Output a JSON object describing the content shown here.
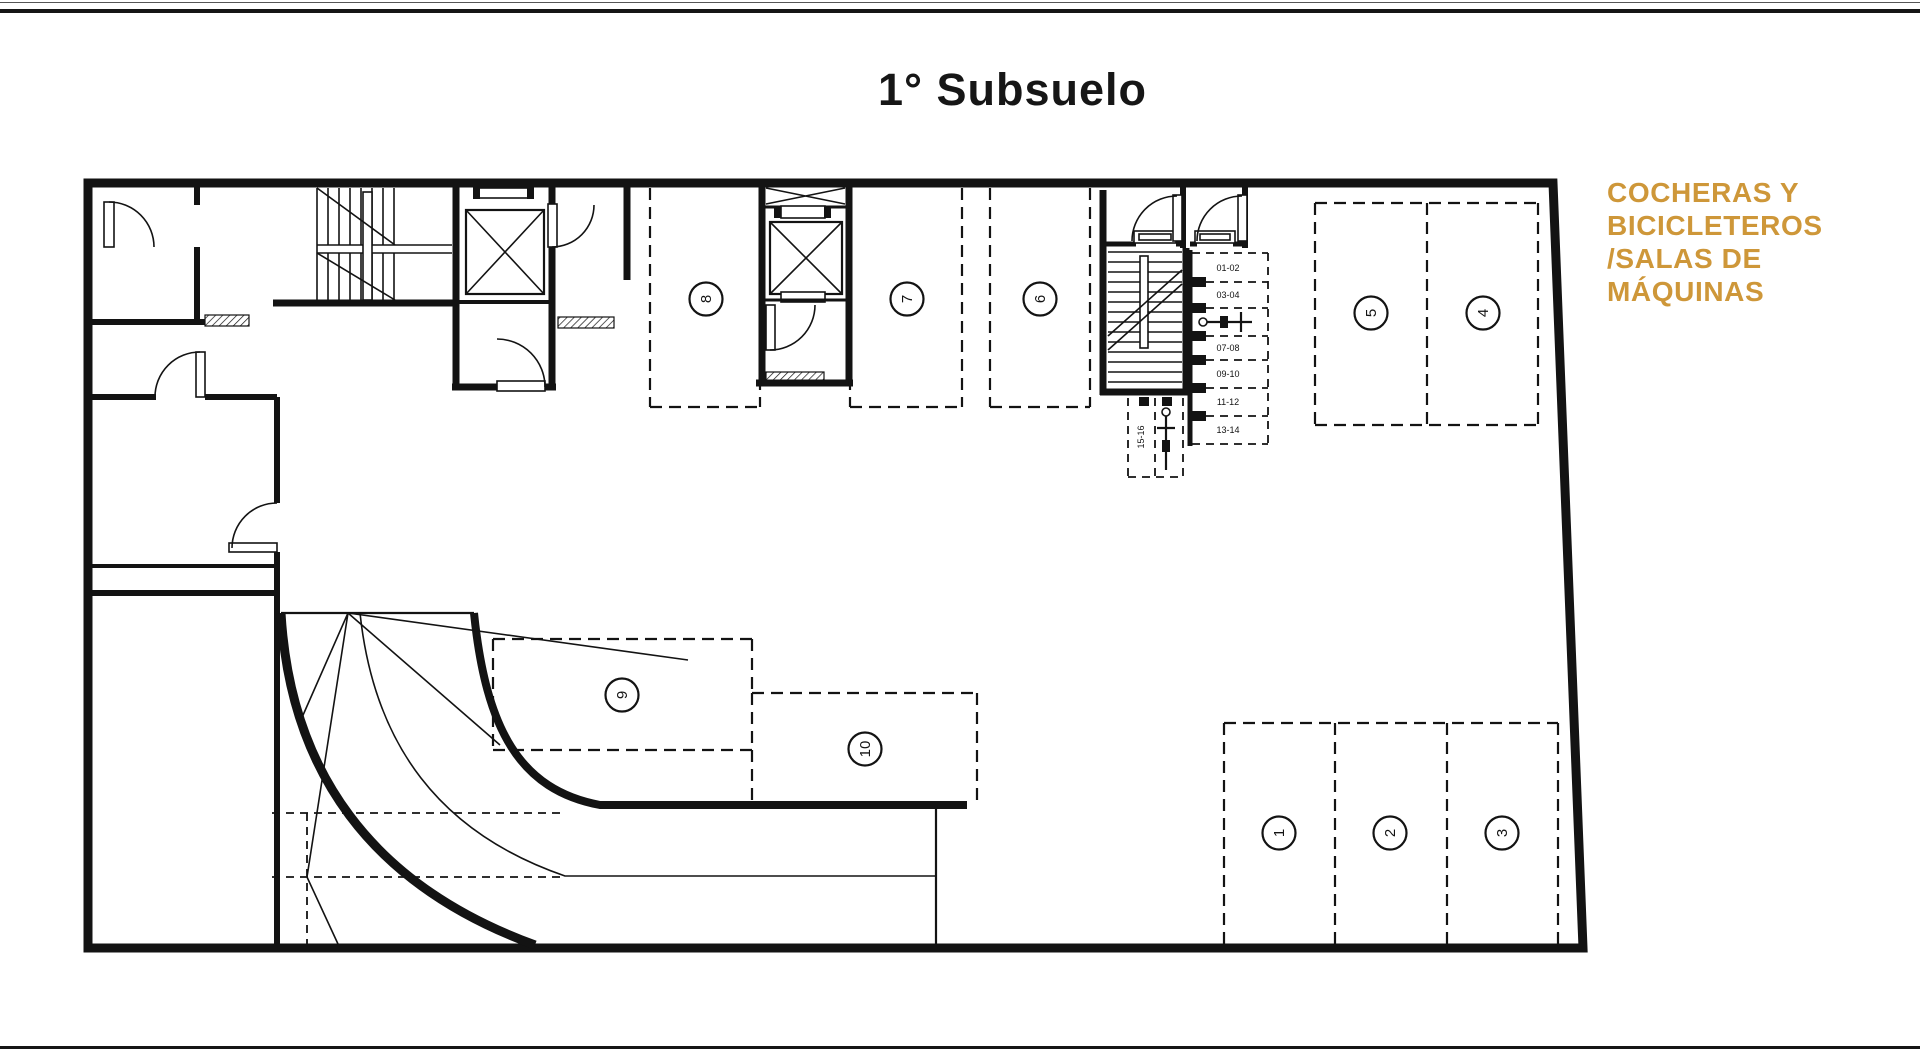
{
  "title": "1° Subsuelo",
  "legend": {
    "color": "#CE9739",
    "lines": [
      "COCHERAS Y",
      "BICICLETEROS",
      "/SALAS DE",
      "MÁQUINAS"
    ]
  },
  "floor_plan": {
    "kind": "basement parking floor plan",
    "line_color": "#131313",
    "parking_space_numbers": [
      "1",
      "2",
      "3",
      "4",
      "5",
      "6",
      "7",
      "8",
      "9",
      "10"
    ],
    "bike_rack_labels": [
      "01-02",
      "03-04",
      "07-08",
      "09-10",
      "11-12",
      "13-14"
    ],
    "bike_stall_label": "15-16"
  }
}
